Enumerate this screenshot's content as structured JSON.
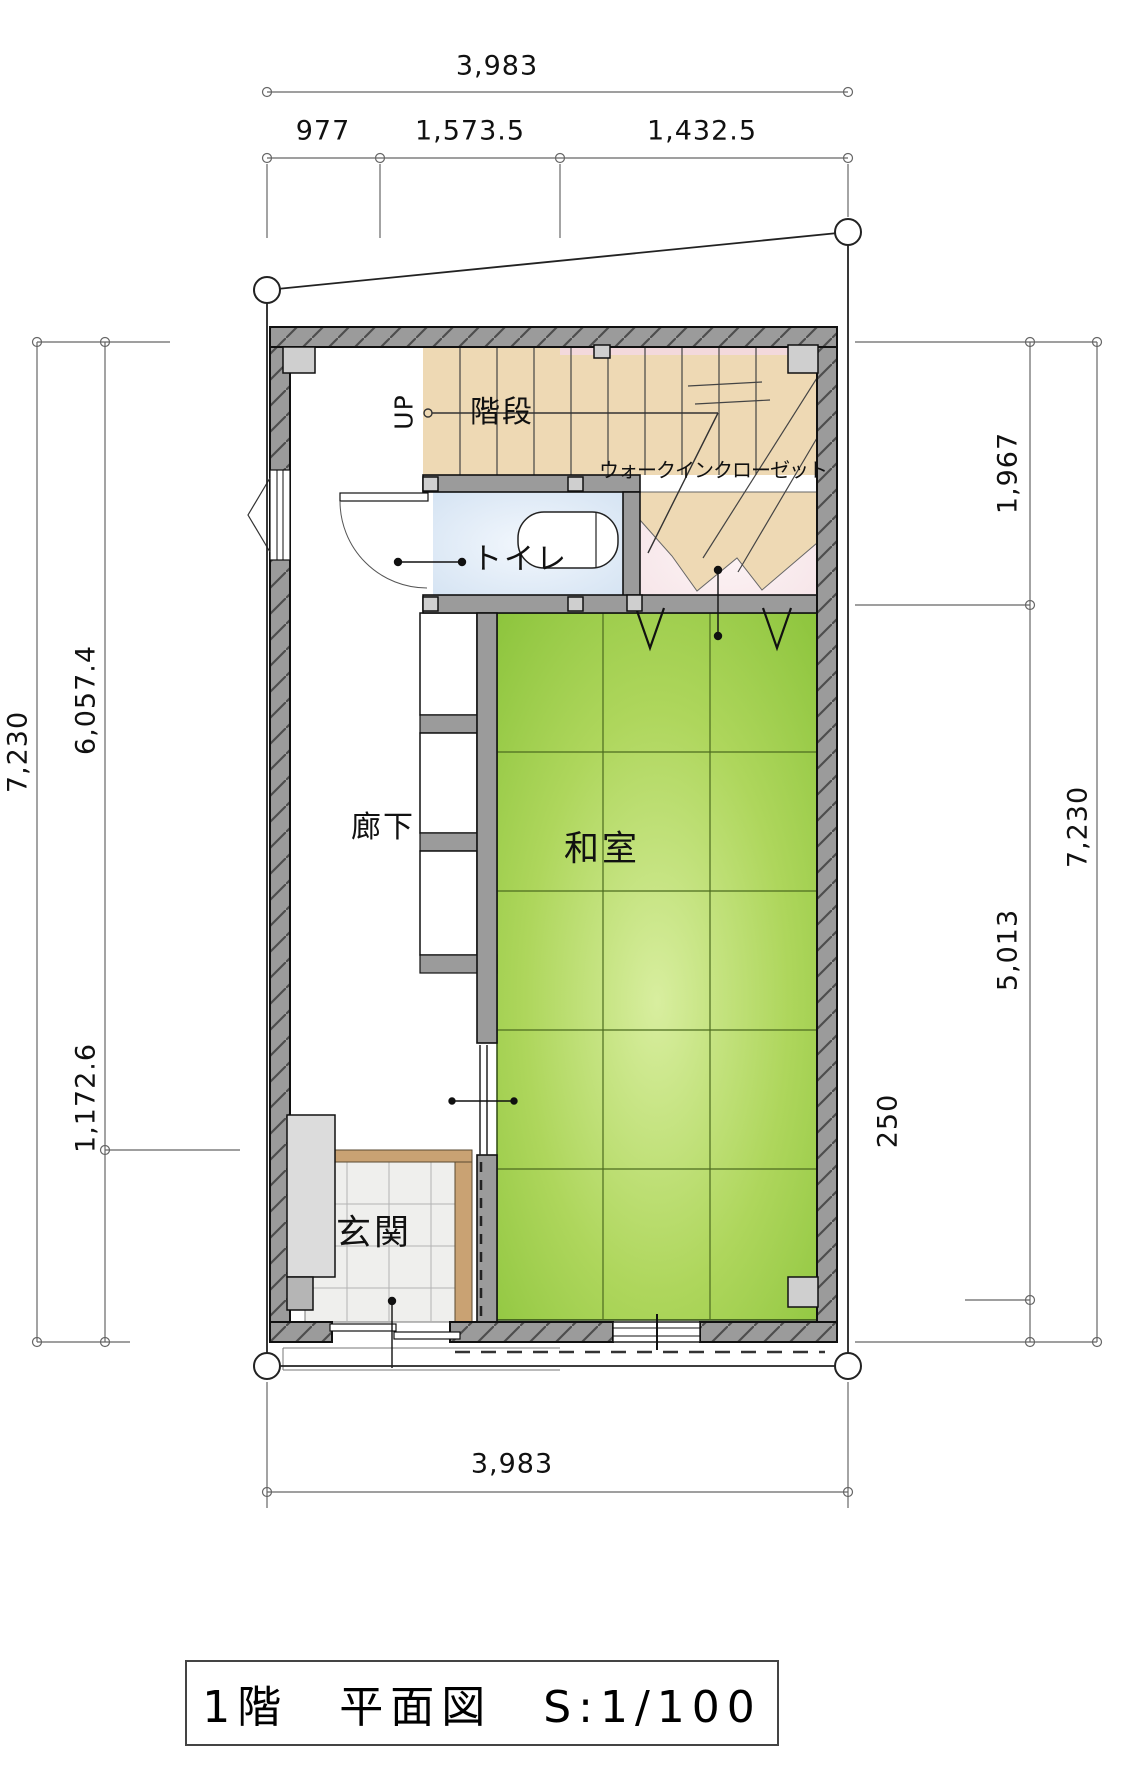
{
  "drawing": {
    "type": "floor-plan",
    "title_block": {
      "text": "1階　平面図　S:1/100"
    }
  },
  "rooms": {
    "stairs": {
      "label": "階段",
      "direction": "UP",
      "floor_color": "#eed9b4"
    },
    "toilet": {
      "label": "トイレ",
      "floor_color": "#dde9f6"
    },
    "wic": {
      "label": "ウォークインクローゼット",
      "floor_color": "#f8e9ec"
    },
    "corridor": {
      "label": "廊下",
      "floor_color": "#ffffff"
    },
    "washitsu": {
      "label": "和室",
      "floor_color": "#a8d24c"
    },
    "genkan": {
      "label": "玄関",
      "floor_color": "#efefed"
    }
  },
  "dimensions": {
    "top": {
      "total": "3,983",
      "segments": [
        "977",
        "1,573.5",
        "1,432.5"
      ]
    },
    "bottom": {
      "total": "3,983"
    },
    "left": {
      "total": "7,230",
      "segments": [
        "6,057.4",
        "1,172.6"
      ]
    },
    "right": {
      "total": "7,230",
      "segments": [
        "1,967",
        "5,013",
        "250"
      ]
    }
  },
  "colors": {
    "wall": "#9b9b9b",
    "post": "#cfcfcf",
    "tatami_green": "#a8d24c",
    "stair_beige": "#eed9b4",
    "toilet_blue": "#dde9f6",
    "wic_pink": "#f8e9ec",
    "genkan_edge_tan": "#c9a273",
    "dimension_line": "#666666"
  }
}
